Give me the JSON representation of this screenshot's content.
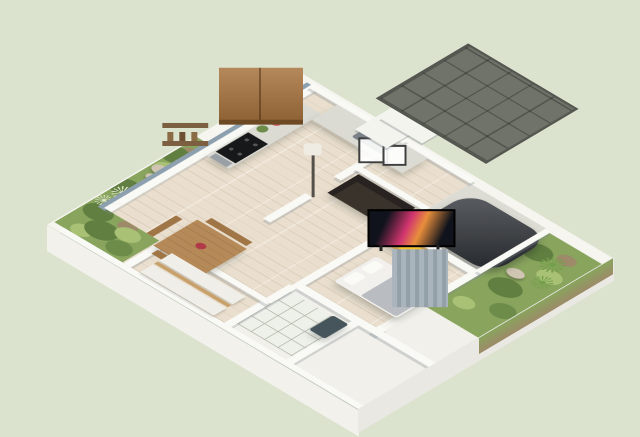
{
  "canvas": {
    "width": 640,
    "height": 417
  },
  "scene": {
    "type": "isometric-3d-floorplan-render",
    "background": "pale sage green",
    "rooms": [
      {
        "name": "kitchen",
        "position": "north-west",
        "items": [
          "wood-upper-cabinets",
          "range-hood",
          "marble-counter-west",
          "marble-counter-north",
          "black-cooktop",
          "steel-oven",
          "sink",
          "spice-wall-shelves",
          "potted-herb",
          "watermelon-plate"
        ]
      },
      {
        "name": "dining-area",
        "position": "west",
        "items": [
          "wood-dining-table",
          "north-bench",
          "south-bench",
          "end-bench",
          "red-flower-centerpiece"
        ]
      },
      {
        "name": "living-room",
        "position": "center",
        "items": [
          "dark-brown-sofa",
          "floor-lamp",
          "wall-frame-large",
          "wall-frame-small",
          "white-ribbed-curtains"
        ]
      },
      {
        "name": "bedroom",
        "position": "east",
        "items": [
          "flat-tv",
          "media-console-with-yellow-shelf",
          "blue-gray-chair",
          "bed-gray-blanket",
          "pillows",
          "gray-curtains-window"
        ]
      },
      {
        "name": "bathroom",
        "position": "south",
        "items": [
          "white-grid-tile-floor",
          "dark-teal-bench-tub"
        ]
      },
      {
        "name": "mat-room",
        "position": "south-west",
        "items": [
          "floor-mat-1",
          "floor-mat-2",
          "wood-slat-divider"
        ]
      },
      {
        "name": "entrance-hall",
        "position": "north",
        "items": [
          "tall-white-tower-volume",
          "flat-white-roof-slab"
        ]
      }
    ],
    "outdoor": [
      {
        "name": "carport",
        "position": "north-east",
        "items": [
          "dark-gray-grid-canopy",
          "support-post-left",
          "support-post-right",
          "dark-car"
        ]
      },
      {
        "name": "east-garden",
        "position": "east",
        "items": [
          "frangipani-tree",
          "agave-plant-1",
          "agave-plant-2",
          "shrubs",
          "rocks",
          "soil-patches"
        ]
      },
      {
        "name": "west-garden-strip",
        "position": "west",
        "items": [
          "potted-trees",
          "grass-bed",
          "rocks",
          "pale-agave-1",
          "pale-agave-2"
        ]
      }
    ],
    "structure": [
      "white-cut-walls",
      "slate-blue-exterior-west-wall",
      "white-platform-plinth"
    ]
  },
  "colors": {
    "bg": "#dbe3cf",
    "platform": "#f6f5f0",
    "plinth_sw": "#f2f1ec",
    "plinth_se": "#e9e8e2",
    "wall": "#f9f9f5",
    "wall_blue": "#8da0af",
    "wood_floor": "#eadfce",
    "tile": "#eef0ea",
    "tile_line": "#b9bdb1",
    "concrete": "#dcdcd4",
    "terrace": "#f1f0ea",
    "garden_base": "#88a45d",
    "garden_dark": "#607f40",
    "garden_light": "#a9c175",
    "foliage_dark": "#6d8c4a",
    "soil": "#9d8a68",
    "rock": "#cfc5b2",
    "canopy": "#70736a",
    "canopy_line": "#54574f",
    "cabinet_wood": "#a8743e",
    "counter": "#dbdbd4",
    "cooktop": "#17181a",
    "steel": "#9aa1a6",
    "sink": "#7b8287",
    "sofa": "#3a332c",
    "sofa_dark": "#282320",
    "table_wood": "#b68a58",
    "bench_wood": "#a07646",
    "flower": "#b23a48",
    "console_wood": "#c9a05e",
    "console_yellow": "#f4c330",
    "console_dark": "#36393f",
    "tv": "#10131c",
    "tv_streak1": "#d1356f",
    "tv_streak2": "#e98f3c",
    "bed_sheet": "#f1f0ec",
    "bed_blanket": "#b9bdc2",
    "pillow": "#fafaf7",
    "chair": "#93a7b4",
    "curtain_white": "#eef1f2",
    "curtain_white2": "#dde3e5",
    "curtain_gray": "#aab4bc",
    "curtain_gray2": "#93a0a8",
    "mat": "#efeee8",
    "mat_wood": "#c8a06a",
    "bath_bench": "#46555c",
    "car": "#2f3338",
    "tower": "#f4f4ef",
    "lamp_shade": "#efece4",
    "lamp_pole": "#55504a",
    "trunk": "#7c5f41",
    "foliage1": "#8aa863",
    "foliage2": "#a3bd7b",
    "pot": "#b5793f",
    "agave": "#74a04b",
    "agave_pale": "#dfe5c8"
  }
}
